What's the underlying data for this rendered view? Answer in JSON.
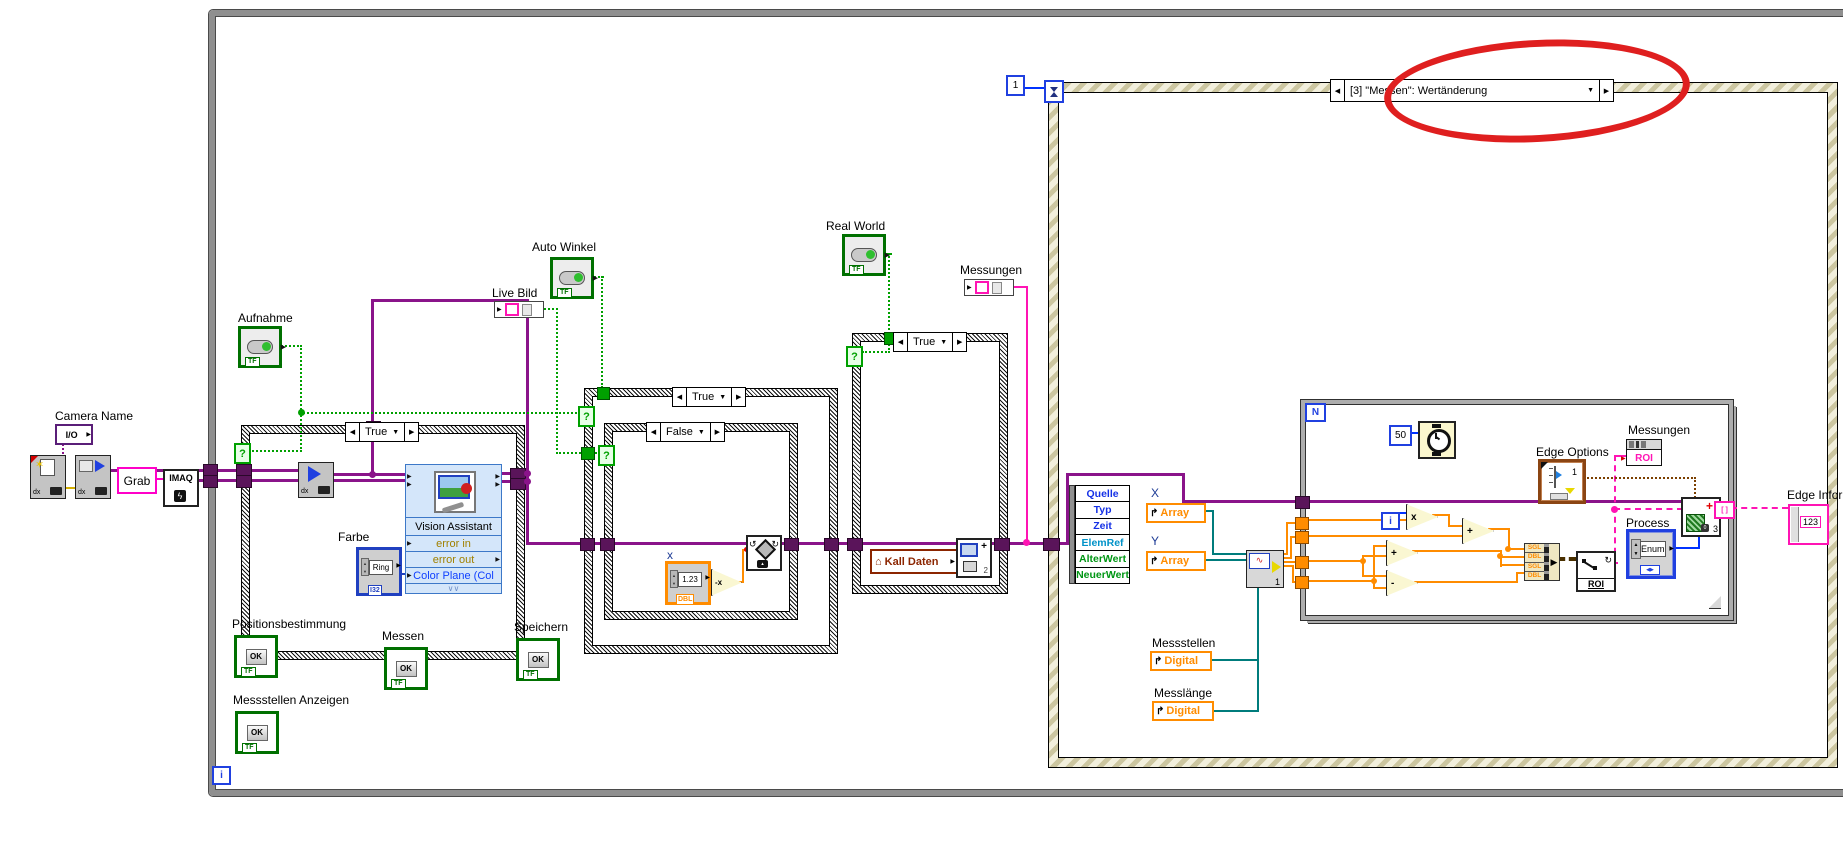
{
  "colors": {
    "image_wire": "#8A148A",
    "bool_wire": "#00A000",
    "numeric_wire": "#FF8C00",
    "int_wire": "#0032FF",
    "roi_wire": "#FF14B4",
    "cluster_wire": "#7B3F00",
    "teal_wire": "#007C7C",
    "bool_border": "#007000",
    "event_border": "#CCC6A0",
    "highlight": "#DF1F1F",
    "express_vi_bg": "#D4E6FA",
    "string_pink": "#FF00C8",
    "global_maroon": "#8B2500"
  },
  "icons": {
    "left": "◀",
    "right": "▶",
    "down": "▼",
    "up_arrow": "↱",
    "house": "⌂",
    "ccw": "↺",
    "cw": "↻",
    "chevron": "∨∨",
    "star": "✶",
    "bolt": "ϟ",
    "squiggle": "∿",
    "q": "?"
  },
  "while_loop": {
    "iteration": "i"
  },
  "event_structure": {
    "timeout_value": "1",
    "selector": "[3] \"Messen\": Wertänderung"
  },
  "case_labels": {
    "true": "True",
    "false": "False"
  },
  "camera_chain": {
    "camera_name": "Camera Name",
    "io": "I/O",
    "dx": "dx",
    "grab_const": "Grab",
    "imaq": "IMAQ"
  },
  "bool_controls": {
    "aufnahme": "Aufnahme",
    "auto_winkel": "Auto Winkel",
    "real_world": "Real World",
    "live_bild": "Live Bild",
    "positionsbestimmung": "Positionsbestimmung",
    "messen": "Messen",
    "speichern": "Speichern",
    "messstellen_anzeigen": "Messstellen Anzeigen",
    "ok": "OK",
    "tf": "TF"
  },
  "vision_assistant": {
    "title": "Vision Assistant",
    "error_in": "error in",
    "error_out": "error out",
    "color_plane": "Color Plane (Col",
    "farbe_label": "Farbe",
    "ring": "Ring",
    "ring_type": "I32"
  },
  "rotate_case": {
    "x_label": "x",
    "x_value": "1.23",
    "x_type": "DBL",
    "negate": "-x"
  },
  "save_case": {
    "kall_daten": "Kall Daten",
    "overlay_count": "2"
  },
  "messungen_top": "Messungen",
  "event_node": {
    "rows": [
      "Quelle",
      "Typ",
      "Zeit",
      "ElemRef",
      "AlterWert",
      "NeuerWert"
    ]
  },
  "locals": {
    "x": "X",
    "y": "Y",
    "array": "Array",
    "messstellen": "Messstellen",
    "messlaenge": "Messlänge",
    "digital": "Digital",
    "vi_index": "1"
  },
  "for_loop": {
    "count": "N",
    "iteration": "i",
    "wait_ms": "50",
    "bundle": [
      "SGL",
      "DBL",
      "SGL",
      "DBL"
    ],
    "multiply": "x",
    "add": "+",
    "subtract": "-",
    "roi": "ROI",
    "edge_options": "Edge Options",
    "edge_options_value": "1",
    "messungen": "Messungen",
    "messungen_type": "ROI",
    "process": "Process",
    "process_value": "Enum",
    "edge_vi_count": "3"
  },
  "edge_inform": {
    "label": "Edge Inform",
    "value": "123"
  }
}
